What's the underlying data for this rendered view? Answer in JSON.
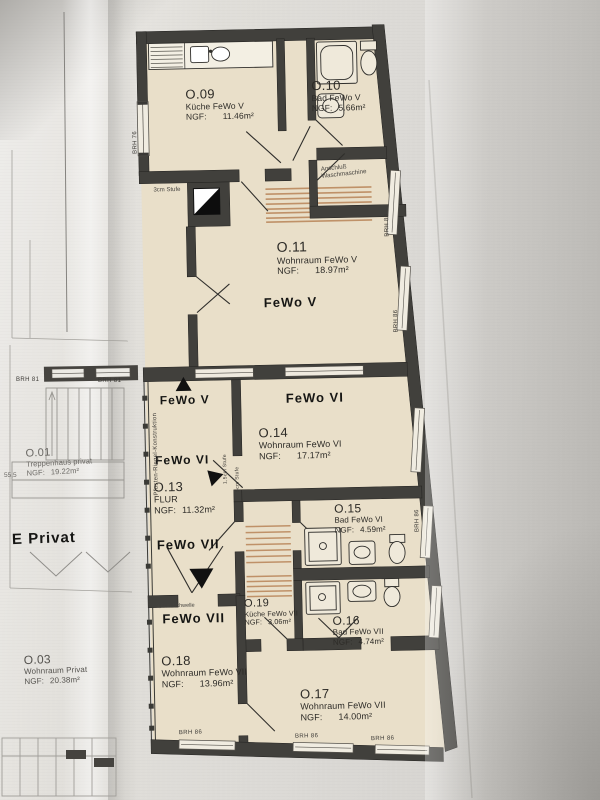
{
  "plan": {
    "rooms": [
      {
        "id": "O.09",
        "name": "Küche FeWo V",
        "ngf": "NGF:",
        "area": "11.46m²"
      },
      {
        "id": "O.10",
        "name": "Bad FeWo V",
        "ngf": "NGF:",
        "area": "5.66m²"
      },
      {
        "id": "O.11",
        "name": "Wohnraum FeWo V",
        "ngf": "NGF:",
        "area": "18.97m²"
      },
      {
        "id": "O.14",
        "name": "Wohnraum FeWo VI",
        "ngf": "NGF:",
        "area": "17.17m²"
      },
      {
        "id": "O.13",
        "name": "FLUR",
        "ngf": "NGF:",
        "area": "11.32m²"
      },
      {
        "id": "O.15",
        "name": "Bad FeWo VI",
        "ngf": "NGF:",
        "area": "4.59m²"
      },
      {
        "id": "O.19",
        "name": "Küche FeWo VII",
        "ngf": "NGF:",
        "area": "3.06m²"
      },
      {
        "id": "O.16",
        "name": "Bad FeWo VII",
        "ngf": "NGF:",
        "area": "4.74m²"
      },
      {
        "id": "O.18",
        "name": "Wohnraum FeWo VII",
        "ngf": "NGF:",
        "area": "13.96m²"
      },
      {
        "id": "O.17",
        "name": "Wohnraum FeWo VII",
        "ngf": "NGF:",
        "area": "14.00m²"
      },
      {
        "id": "O.01",
        "name": "Treppenhaus privat",
        "ngf": "NGF:",
        "area": "19.22m²"
      },
      {
        "id": "O.03",
        "name": "Wohnraum Privat",
        "ngf": "NGF:",
        "area": "20.38m²"
      }
    ],
    "zones": {
      "fewo5": "FeWo V",
      "fewo6": "FeWo VI",
      "fewo7": "FeWo VII",
      "fewo5_dir": "FeWo V",
      "fewo6_dir": "FeWo VI",
      "fewo7_dir": "FeWo VII",
      "e_privat": "E Privat"
    },
    "notes": {
      "anschluss1": "Anschluß",
      "anschluss2": "Waschmaschine",
      "stufe3": "3cm Stufe",
      "stufe15": "1,5cm Stufe",
      "stufe5": "5cm Stufe",
      "schwelle": "3,5cm Schwelle",
      "pfosten": "Pfosten-Riegel-Konstruktion",
      "dim": "55,5"
    },
    "windows": {
      "brh81a": "BRH 81",
      "brh81b": "BRH 81",
      "brh76": "BRH 76",
      "brh86r1": "BRH 86",
      "brh86r2": "BRH 86",
      "brh86r3": "BRH 86",
      "brh86b1": "BRH 86",
      "brh86b2": "BRH 86",
      "brh86b3": "BRH 86"
    },
    "colors": {
      "wall": "#41403c",
      "room": "#e9dfc9",
      "hatch": "#bf9168",
      "paper": "#dedcd8"
    }
  }
}
